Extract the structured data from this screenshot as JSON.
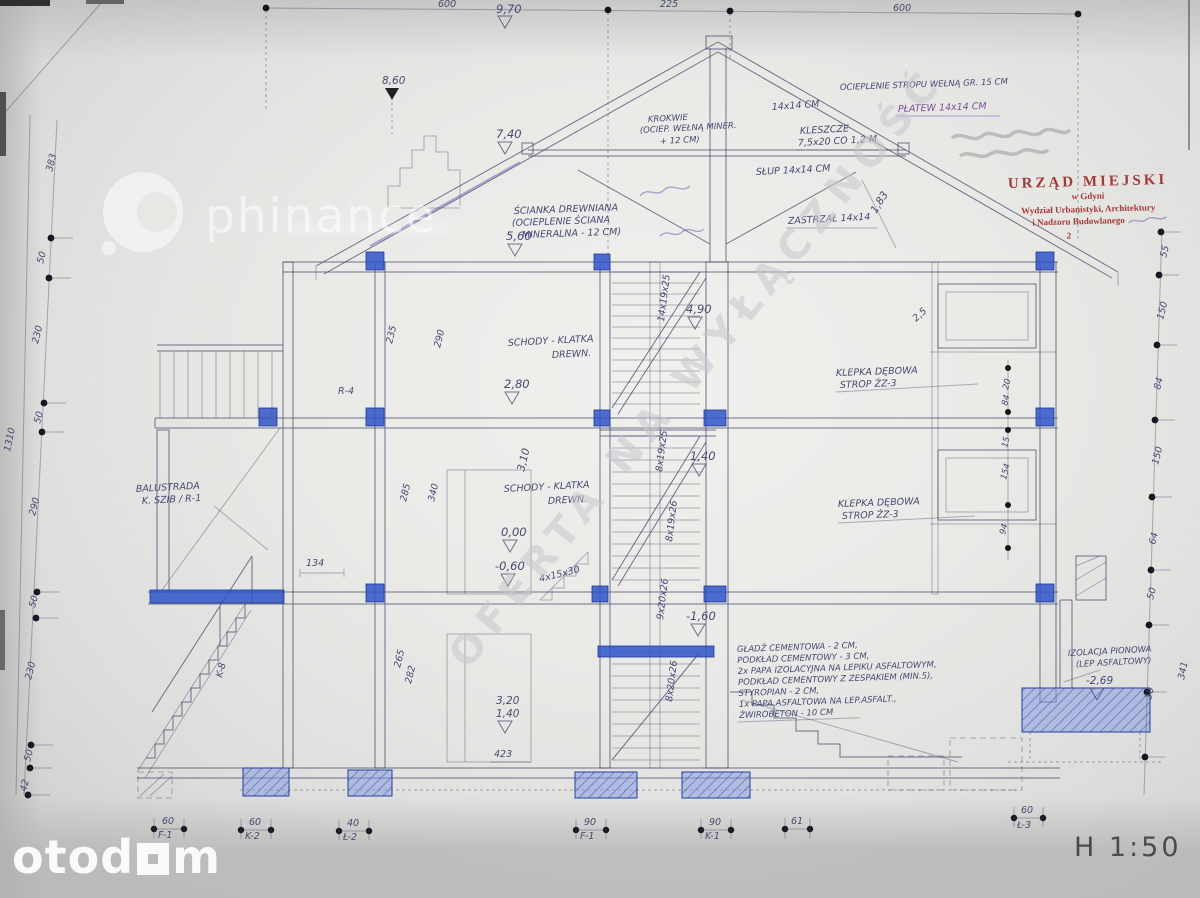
{
  "page": {
    "scale": "H 1:50"
  },
  "watermarks": {
    "brand": "phinance",
    "portal_prefix": "otod",
    "portal_suffix": "m",
    "diagonal": "OFERTA NA WYŁĄCZNOŚĆ"
  },
  "stamp": {
    "l1": "URZĄD MIEJSKI",
    "l2": "w Gdyni",
    "l3": "Wydział Urbanistyki, Architektury",
    "l4": "i Nadzoru Budowlanego",
    "l5": "2"
  },
  "elev": [
    "9,70",
    "8,60",
    "7,40",
    "5,60",
    "4,90",
    "2,80",
    "1,40",
    "0,00",
    "-0,60",
    "-1,60",
    "3,20",
    "1,40",
    "-2,69"
  ],
  "dims": {
    "top": [
      "600",
      "225",
      "600"
    ],
    "left": [
      "383",
      "50",
      "230",
      "50",
      "290",
      "50",
      "230",
      "50",
      "42",
      "1310"
    ],
    "right": [
      "55",
      "150",
      "84",
      "150",
      "64",
      "50",
      "30",
      "341"
    ],
    "inner_right": [
      "20",
      "84",
      "15",
      "154",
      "94"
    ],
    "misc": [
      "235",
      "290",
      "285",
      "340",
      "3,10",
      "265",
      "282",
      "134",
      "423",
      "2,5",
      "1,83"
    ],
    "stairs": [
      "14x19x25",
      "8x19x25",
      "8x19x26",
      "9x20x26",
      "8x20x26",
      "4x15x30"
    ]
  },
  "labels": {
    "scianka1": "ŚCIANKA DREWNIANA",
    "scianka2": "(OCIEPLENIE ŚCIANA",
    "scianka3": "MINERALNA - 12 CM)",
    "krokwie1": "KROKWIE",
    "krokwie2": "(OCIEP. WEŁNĄ MINER.",
    "krokwie3": "+ 12 CM)",
    "kleszcze1": "KLESZCZE",
    "kleszcze2": "7,5x20 CO 1,2 M",
    "slup": "SŁUP 14x14 CM",
    "belka": "14x14 CM",
    "zastrzal": "ZASTRZAŁ 14x14",
    "ocieplenie": "OCIEPLENIE STROPU WEŁNĄ GR. 15 CM",
    "platew": "PŁATEW 14x14 CM",
    "schody1": "SCHODY - KLATKA",
    "schody2": "DREWN.",
    "klepka1": "KLEPKA DĘBOWA",
    "klepka2": "STROP ŻZ-3",
    "balustrada1": "BALUSTRADA",
    "balustrada2": "K. SZIB / R-1",
    "izolacja1": "IZOLACJA PIONOWA",
    "izolacja2": "(LEP ASFALTOWY)",
    "r4": "R-4",
    "k8": "K-8"
  },
  "floor_spec": [
    "GŁADŹ CEMENTOWA - 2 CM,",
    "PODKŁAD CEMENTOWY - 3 CM,",
    "2x PAPA IZOLACYJNA NA LEPIKU ASFALTOWYM,",
    "PODKŁAD CEMENTOWY Z ZESPAKIEM (MIN.5),",
    "STYROPIAN - 2 CM,",
    "1x PAPA ASFALTOWA NA LEP.ASFALT.,",
    "ŻWIROBETON - 10 CM"
  ],
  "footings": [
    {
      "w": "60",
      "n": "F-1"
    },
    {
      "w": "60",
      "n": "K-2"
    },
    {
      "w": "40",
      "n": "Ł-2"
    },
    {
      "w": "90",
      "n": "F-1"
    },
    {
      "w": "90",
      "n": "K-1"
    },
    {
      "w": "61",
      "n": ""
    },
    {
      "w": "60",
      "n": "Ł-3"
    }
  ]
}
